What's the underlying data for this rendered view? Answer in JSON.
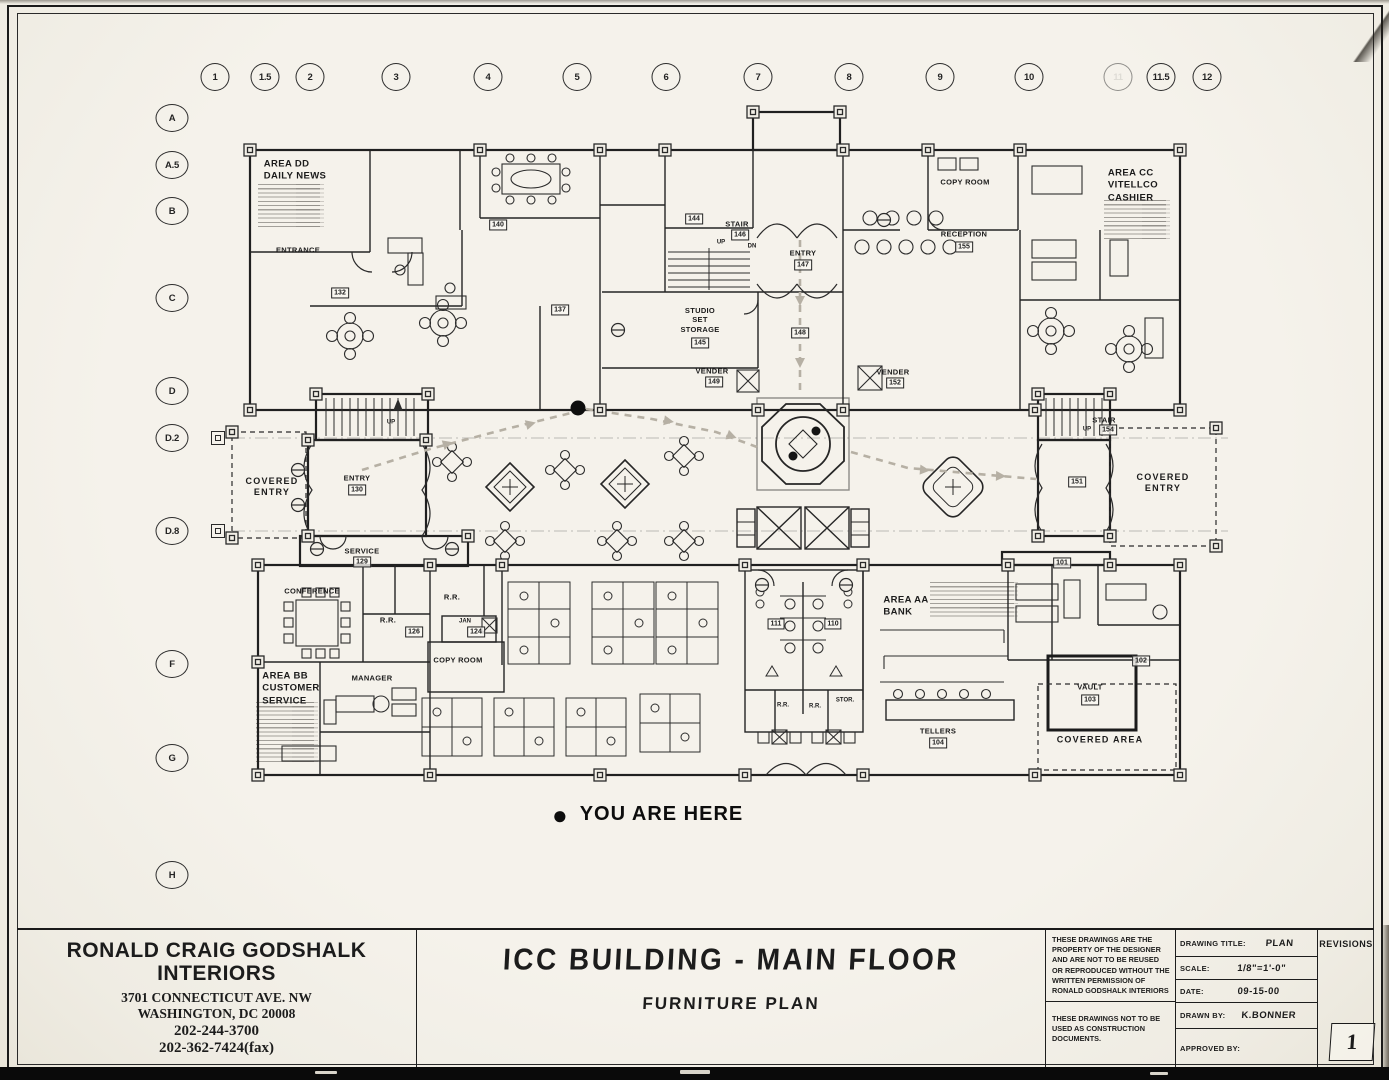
{
  "sheet": {
    "paper_color": "#f2efe7",
    "ink_color": "#1c1c1c",
    "route_color": "#b6b0a4"
  },
  "grid": {
    "column_y": 77,
    "row_x": 172,
    "marker_x": 218,
    "columns": [
      {
        "label": "1",
        "x": 215
      },
      {
        "label": "1.5",
        "x": 265
      },
      {
        "label": "2",
        "x": 310
      },
      {
        "label": "3",
        "x": 396
      },
      {
        "label": "4",
        "x": 488
      },
      {
        "label": "5",
        "x": 577
      },
      {
        "label": "6",
        "x": 666
      },
      {
        "label": "7",
        "x": 758
      },
      {
        "label": "8",
        "x": 849
      },
      {
        "label": "9",
        "x": 940
      },
      {
        "label": "10",
        "x": 1029
      },
      {
        "label": "11",
        "x": 1118,
        "faded": true
      },
      {
        "label": "11.5",
        "x": 1161
      },
      {
        "label": "12",
        "x": 1207
      }
    ],
    "rows": [
      {
        "label": "A",
        "y": 118
      },
      {
        "label": "A.5",
        "y": 165
      },
      {
        "label": "B",
        "y": 211
      },
      {
        "label": "C",
        "y": 298
      },
      {
        "label": "D",
        "y": 391
      },
      {
        "label": "D.2",
        "y": 438,
        "marker": true
      },
      {
        "label": "D.8",
        "y": 531,
        "marker": true
      },
      {
        "label": "F",
        "y": 664
      },
      {
        "label": "G",
        "y": 758
      },
      {
        "label": "H",
        "y": 875
      }
    ]
  },
  "legend": {
    "marker": "●",
    "text": "YOU ARE HERE"
  },
  "plan": {
    "labels": [
      {
        "t": "AREA DD\nDAILY NEWS",
        "x": 295,
        "y": 171,
        "c": "a"
      },
      {
        "t": "AREA CC\nVITELLCO\nCASHIER",
        "x": 1133,
        "y": 186,
        "c": "a"
      },
      {
        "t": "AREA BB\nCUSTOMER\nSERVICE",
        "x": 291,
        "y": 689,
        "c": "a"
      },
      {
        "t": "AREA AA\nBANK",
        "x": 906,
        "y": 607,
        "c": "a"
      },
      {
        "t": "ENTRANCE",
        "x": 298,
        "y": 250,
        "c": "r"
      },
      {
        "t": "COPY ROOM",
        "x": 965,
        "y": 182,
        "c": "r"
      },
      {
        "t": "RECEPTION",
        "x": 964,
        "y": 234,
        "c": "r"
      },
      {
        "t": "155",
        "x": 964,
        "y": 247,
        "c": "t"
      },
      {
        "t": "STAIR",
        "x": 737,
        "y": 224,
        "c": "r"
      },
      {
        "t": "146",
        "x": 740,
        "y": 235,
        "c": "t"
      },
      {
        "t": "UP",
        "x": 721,
        "y": 243,
        "c": "y"
      },
      {
        "t": "DN",
        "x": 752,
        "y": 247,
        "c": "y"
      },
      {
        "t": "ENTRY",
        "x": 803,
        "y": 253,
        "c": "r"
      },
      {
        "t": "147",
        "x": 803,
        "y": 265,
        "c": "t"
      },
      {
        "t": "148",
        "x": 800,
        "y": 333,
        "c": "t"
      },
      {
        "t": "STUDIO\nSET\nSTORAGE",
        "x": 700,
        "y": 320,
        "c": "r"
      },
      {
        "t": "145",
        "x": 700,
        "y": 343,
        "c": "t"
      },
      {
        "t": "VENDER",
        "x": 712,
        "y": 371,
        "c": "r"
      },
      {
        "t": "149",
        "x": 714,
        "y": 382,
        "c": "t"
      },
      {
        "t": "VENDER",
        "x": 893,
        "y": 372,
        "c": "r"
      },
      {
        "t": "152",
        "x": 895,
        "y": 383,
        "c": "t"
      },
      {
        "t": "144",
        "x": 694,
        "y": 219,
        "c": "t"
      },
      {
        "t": "140",
        "x": 498,
        "y": 225,
        "c": "t"
      },
      {
        "t": "137",
        "x": 560,
        "y": 310,
        "c": "t"
      },
      {
        "t": "132",
        "x": 340,
        "y": 293,
        "c": "t"
      },
      {
        "t": "UP",
        "x": 391,
        "y": 423,
        "c": "y"
      },
      {
        "t": "ENTRY",
        "x": 357,
        "y": 478,
        "c": "r"
      },
      {
        "t": "130",
        "x": 357,
        "y": 490,
        "c": "t"
      },
      {
        "t": "SERVICE",
        "x": 362,
        "y": 551,
        "c": "r"
      },
      {
        "t": "129",
        "x": 362,
        "y": 562,
        "c": "t"
      },
      {
        "t": "COVERED\nENTRY",
        "x": 272,
        "y": 487,
        "c": "cv"
      },
      {
        "t": "COVERED\nENTRY",
        "x": 1163,
        "y": 483,
        "c": "cv"
      },
      {
        "t": "STAIR",
        "x": 1104,
        "y": 420,
        "c": "r"
      },
      {
        "t": "UP",
        "x": 1087,
        "y": 430,
        "c": "y"
      },
      {
        "t": "154",
        "x": 1108,
        "y": 430,
        "c": "t"
      },
      {
        "t": "151",
        "x": 1077,
        "y": 482,
        "c": "t"
      },
      {
        "t": "101",
        "x": 1062,
        "y": 563,
        "c": "t"
      },
      {
        "t": "CONFERENCE",
        "x": 312,
        "y": 591,
        "c": "r"
      },
      {
        "t": "R.R.",
        "x": 388,
        "y": 620,
        "c": "r"
      },
      {
        "t": "MANAGER",
        "x": 372,
        "y": 678,
        "c": "r"
      },
      {
        "t": "126",
        "x": 414,
        "y": 632,
        "c": "t"
      },
      {
        "t": "R.R.",
        "x": 452,
        "y": 597,
        "c": "r"
      },
      {
        "t": "JAN",
        "x": 465,
        "y": 622,
        "c": "y"
      },
      {
        "t": "124",
        "x": 476,
        "y": 632,
        "c": "t"
      },
      {
        "t": "COPY ROOM",
        "x": 458,
        "y": 660,
        "c": "r"
      },
      {
        "t": "111",
        "x": 776,
        "y": 624,
        "c": "t"
      },
      {
        "t": "110",
        "x": 833,
        "y": 624,
        "c": "t"
      },
      {
        "t": "R.R.",
        "x": 783,
        "y": 706,
        "c": "y"
      },
      {
        "t": "R.R.",
        "x": 815,
        "y": 707,
        "c": "y"
      },
      {
        "t": "STOR.",
        "x": 845,
        "y": 701,
        "c": "y"
      },
      {
        "t": "TELLERS",
        "x": 938,
        "y": 731,
        "c": "r"
      },
      {
        "t": "104",
        "x": 938,
        "y": 743,
        "c": "t"
      },
      {
        "t": "VAULT",
        "x": 1090,
        "y": 687,
        "c": "r"
      },
      {
        "t": "103",
        "x": 1090,
        "y": 700,
        "c": "t"
      },
      {
        "t": "COVERED AREA",
        "x": 1100,
        "y": 740,
        "c": "cv"
      },
      {
        "t": "102",
        "x": 1141,
        "y": 661,
        "c": "t"
      }
    ]
  },
  "titleblock": {
    "firm_name_line1": "RONALD CRAIG GODSHALK",
    "firm_name_line2": "INTERIORS",
    "address_line1": "3701 CONNECTICUT AVE. NW",
    "address_line2": "WASHINGTON, DC  20008",
    "phone": "202-244-3700",
    "fax": "202-362-7424(fax)",
    "project_title": "ICC BUILDING - MAIN FLOOR",
    "sheet_subtitle": "FURNITURE PLAN",
    "note1": "These drawings are the property of the designer and are not to be reused or reproduced without the written permission of Ronald Godshalk Interiors",
    "note2": "These drawings not to be used as construction documents.",
    "drawing_title_label": "DRAWING TITLE:",
    "drawing_title_value": "PLAN",
    "scale_label": "SCALE:",
    "scale_value": "1/8\"=1'-0\"",
    "date_label": "DATE:",
    "date_value": "09-15-00",
    "drawn_by_label": "DRAWN BY:",
    "drawn_by_value": "K.BONNER",
    "approved_by_label": "APPROVED BY:",
    "approved_by_value": "",
    "revisions_label": "REVISIONS",
    "sheet_number": "1"
  }
}
